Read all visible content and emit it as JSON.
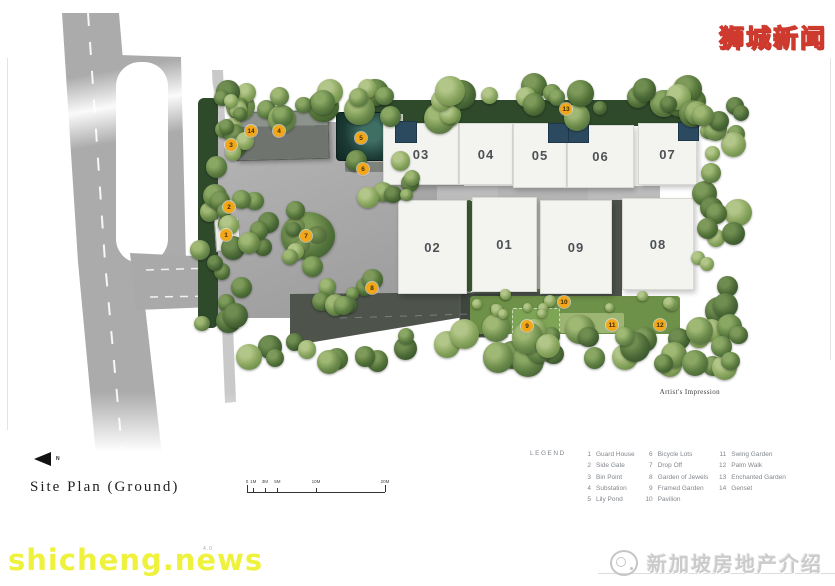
{
  "watermarks": {
    "top_right": "狮城新闻",
    "bottom_left": "shicheng.news",
    "bottom_right": "新加坡房地产介绍",
    "page_number": "4.0"
  },
  "plan": {
    "title": "Site Plan (Ground)",
    "north_label": "N",
    "artist_note": "Artist's Impression",
    "buildings": [
      {
        "label": "03",
        "x": 383,
        "y": 123,
        "w": 74,
        "h": 60
      },
      {
        "label": "04",
        "x": 459,
        "y": 123,
        "w": 52,
        "h": 60
      },
      {
        "label": "05",
        "x": 513,
        "y": 123,
        "w": 52,
        "h": 63
      },
      {
        "label": "06",
        "x": 567,
        "y": 125,
        "w": 65,
        "h": 61
      },
      {
        "label": "07",
        "x": 638,
        "y": 123,
        "w": 57,
        "h": 60
      },
      {
        "label": "02",
        "x": 398,
        "y": 200,
        "w": 67,
        "h": 92
      },
      {
        "label": "01",
        "x": 472,
        "y": 197,
        "w": 63,
        "h": 93
      },
      {
        "label": "09",
        "x": 540,
        "y": 200,
        "w": 70,
        "h": 92
      },
      {
        "label": "08",
        "x": 622,
        "y": 198,
        "w": 70,
        "h": 90
      }
    ],
    "markers": [
      {
        "n": "1",
        "x": 226,
        "y": 235
      },
      {
        "n": "2",
        "x": 229,
        "y": 207
      },
      {
        "n": "3",
        "x": 231,
        "y": 145
      },
      {
        "n": "4",
        "x": 279,
        "y": 131
      },
      {
        "n": "5",
        "x": 361,
        "y": 138
      },
      {
        "n": "6",
        "x": 363,
        "y": 169
      },
      {
        "n": "7",
        "x": 306,
        "y": 236
      },
      {
        "n": "8",
        "x": 372,
        "y": 288
      },
      {
        "n": "9",
        "x": 527,
        "y": 326
      },
      {
        "n": "10",
        "x": 564,
        "y": 302
      },
      {
        "n": "11",
        "x": 612,
        "y": 325
      },
      {
        "n": "12",
        "x": 660,
        "y": 325
      },
      {
        "n": "13",
        "x": 566,
        "y": 109
      },
      {
        "n": "14",
        "x": 251,
        "y": 131
      }
    ]
  },
  "scale_bar": {
    "labels": [
      {
        "t": "0",
        "p": 0
      },
      {
        "t": "1M",
        "p": 4.5
      },
      {
        "t": "3M",
        "p": 13
      },
      {
        "t": "5M",
        "p": 22
      },
      {
        "t": "10M",
        "p": 50
      },
      {
        "t": "20M",
        "p": 100
      }
    ]
  },
  "legend": {
    "title": "LEGEND",
    "columns": [
      [
        {
          "n": "1",
          "label": "Guard House"
        },
        {
          "n": "2",
          "label": "Side Gate"
        },
        {
          "n": "3",
          "label": "Bin Point"
        },
        {
          "n": "4",
          "label": "Substation"
        },
        {
          "n": "5",
          "label": "Lily Pond"
        }
      ],
      [
        {
          "n": "6",
          "label": "Bicycle Lots"
        },
        {
          "n": "7",
          "label": "Drop Off"
        },
        {
          "n": "8",
          "label": "Garden of Jewels"
        },
        {
          "n": "9",
          "label": "Framed Garden"
        },
        {
          "n": "10",
          "label": "Pavilion"
        }
      ],
      [
        {
          "n": "11",
          "label": "Swing Garden"
        },
        {
          "n": "12",
          "label": "Palm Walk"
        },
        {
          "n": "13",
          "label": "Enchanted Garden"
        },
        {
          "n": "14",
          "label": "Genset"
        }
      ]
    ]
  },
  "colors": {
    "marker_bg": "#F2A71B",
    "roof_blue": "#2B4A60",
    "building_fill": "#F3F3EF",
    "watermark_yellow": "#EEF23C",
    "watermark_red_outline": "#CF3A2E"
  }
}
